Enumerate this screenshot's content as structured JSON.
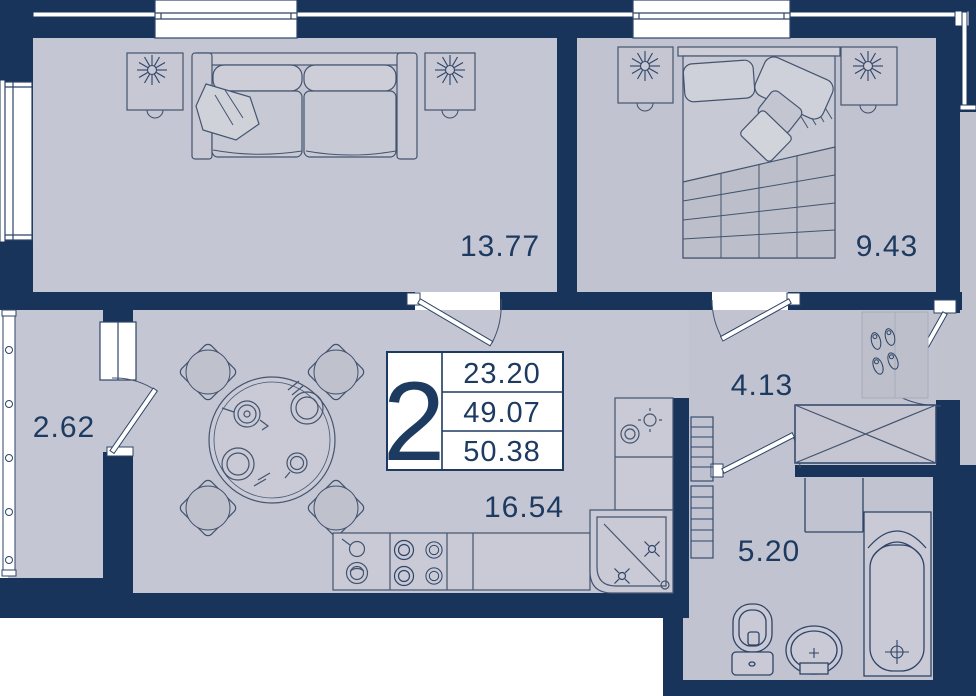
{
  "plan": {
    "type": "apartment-floor-plan",
    "colors": {
      "wall": "#18345a",
      "floor": "#c5c6d3",
      "floor_outside": "#c0c2ce",
      "furniture_fill": "#c8c9d4",
      "accent_text": "#1d3a60",
      "line": "#44546f",
      "white": "#ffffff"
    },
    "legend": {
      "rooms_count": "2",
      "row1": "23.20",
      "row2": "49.07",
      "row3": "50.38"
    },
    "rooms": [
      {
        "id": "living-room",
        "area": "13.77"
      },
      {
        "id": "bedroom",
        "area": "9.43"
      },
      {
        "id": "balcony",
        "area": "2.62"
      },
      {
        "id": "hallway",
        "area": "4.13"
      },
      {
        "id": "kitchen-living",
        "area": "16.54"
      },
      {
        "id": "bathroom",
        "area": "5.20"
      }
    ],
    "furniture_icons": [
      "sofa-icon",
      "side-table-icon",
      "plant-icon",
      "bed-icon",
      "nightstand-icon",
      "dining-table-icon",
      "chair-icon",
      "stove-icon",
      "corner-sink-icon",
      "counter-icon",
      "drying-rack-icon",
      "wardrobe-icon",
      "shoe-mat-icon",
      "toilet-icon",
      "washbasin-icon",
      "bathtub-icon",
      "door-icon",
      "window-icon"
    ]
  }
}
